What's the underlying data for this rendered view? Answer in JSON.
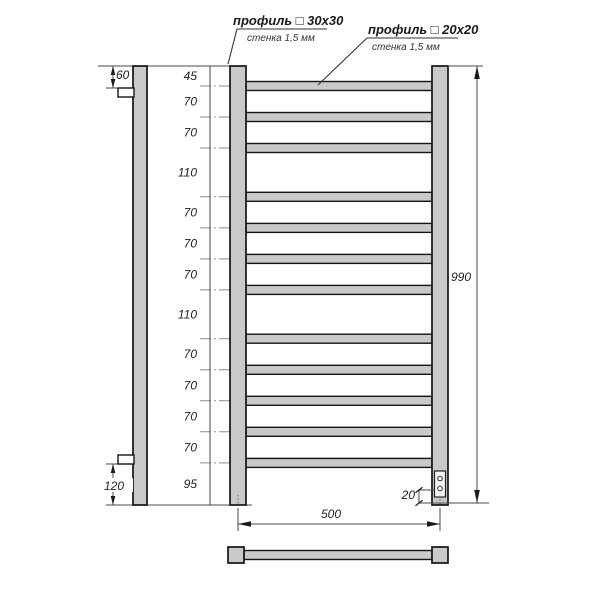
{
  "diagram": {
    "description": "Dimensioned technical drawing of a ladder towel rail (front view, side view, plan view)",
    "callouts": {
      "profile_30": {
        "line1": "профиль □ 30x30",
        "line2": "стенка 1,5 мм"
      },
      "profile_20": {
        "line1": "профиль □ 20x20",
        "line2": "стенка 1,5 мм"
      }
    },
    "dimensions": {
      "left_chain_mm": [
        45,
        70,
        70,
        110,
        70,
        70,
        70,
        110,
        70,
        70,
        70,
        70,
        95
      ],
      "total_height": "990",
      "width": "500",
      "panel_offset": "20",
      "bracket_top_offset": "60",
      "bracket_bottom_offset": "120"
    },
    "geometry": {
      "total_height_mm": 990,
      "crossbar_count": 12,
      "panel_circle_count": 2
    },
    "colors": {
      "metal_fill": "#c9c9c9",
      "outline": "#141414",
      "dim_line": "#4a4a4a",
      "text": "#222222",
      "background": "#ffffff"
    }
  }
}
